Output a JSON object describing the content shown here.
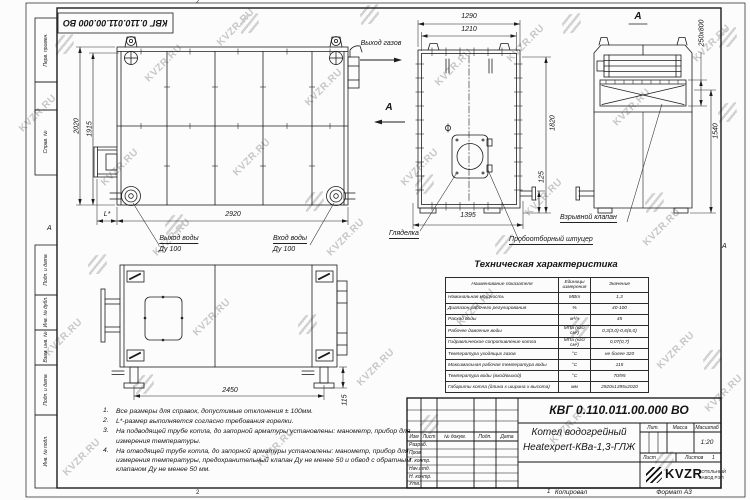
{
  "doc": {
    "number": "КВГ 0.110.011.00.000 ВО",
    "product_line1": "Котел водогрейный",
    "product_line2": "Heatexpert-КВа-1,3-ГЛЖ",
    "scale_value": "1:20",
    "sheets_value": "1",
    "copied": "Копировал",
    "format": "Формат А3",
    "company_name": "KVZR",
    "company_desc1": "КОТЕЛЬНЫЙ",
    "company_desc2": "ЗАВОД РЭП"
  },
  "stamp": {
    "header_cols": [
      "Изм",
      "Лист",
      "№ докум.",
      "Подп.",
      "Дата"
    ],
    "rows": [
      "Разраб.",
      "Пров.",
      "Т. контр.",
      "Нач.отд.",
      "Н. контр.",
      "Утв."
    ],
    "lit_label": "Лит.",
    "mass_label": "Масса",
    "scale_label": "Масштаб",
    "sheet_label": "Лист",
    "sheets_label": "Листов"
  },
  "margin_labels": {
    "perv": "Перв. примен.",
    "sprav": "Справ. №",
    "podp1": "Подп. и дата",
    "inv_dubl": "Инв. № дубл.",
    "vzam": "Взам. инв. №",
    "podp2": "Подп. и дата",
    "inv_podl": "Инв. № подл."
  },
  "zones": {
    "top": "2",
    "bottom": "2",
    "left": "А",
    "right": "А",
    "sheet_num": "1"
  },
  "views": {
    "side": {
      "dim_height_outer": "2020",
      "dim_height_inner": "1915",
      "dim_width": "2920",
      "dim_l": "L*",
      "label_gas_out": "Выход газов",
      "view_arrow": "А",
      "label_water_out1": "Выход воды",
      "label_water_out2": "Ду 100",
      "label_water_in1": "Вход воды",
      "label_water_in2": "Ду 100"
    },
    "front": {
      "dim_top1": "1290",
      "dim_top2": "1210",
      "dim_right": "1820",
      "dim_bottom_small": "125",
      "dim_bottom": "1395",
      "label_sight": "Гляделка",
      "label_sampler": "Пробоотборный штуцер"
    },
    "viewA": {
      "title": "А",
      "dim_flue": "250x800",
      "dim_height": "1540",
      "label_valve": "Взрывной клапан"
    },
    "plan": {
      "dim_width": "2450",
      "dim_feet": "115"
    }
  },
  "notes": [
    "Все размеры для справок, допустимые отклонения ± 100мм.",
    "L*-размер выполняется согласно требования горелки.",
    "На подводящей трубе котла, до запорной арматуры установлены: манометр, прибор для измерения температуры.",
    "На отводящей трубе котла, до запорной арматуры установлены: манометр, прибор для измерения температуры, предохранительный клапан Ду не менее 50 и обвод с обратным клапаном Ду не менее 50 мм."
  ],
  "table": {
    "title": "Техническая характеристика",
    "col_name": "Наименование показателя",
    "col_units": "Единицы измерения",
    "col_value": "Значение",
    "rows": [
      {
        "name": "Номинальная мощность",
        "units": "МВт",
        "value": "1,3"
      },
      {
        "name": "Диапазон рабочего регулирования",
        "units": "%",
        "value": "40-100"
      },
      {
        "name": "Расход воды",
        "units": "м³/ч",
        "value": "45"
      },
      {
        "name": "Рабочее давление воды",
        "units": "МПа (кгс/см²)",
        "value": "0,3(3,0)-0,6(6,0)"
      },
      {
        "name": "Гидравлическое сопротивление котла",
        "units": "МПа (кгс/см²)",
        "value": "0,07(0,7)"
      },
      {
        "name": "Температура уходящих газов",
        "units": "°С",
        "value": "не более 320"
      },
      {
        "name": "Максимальная рабочая температура воды",
        "units": "°С",
        "value": "115"
      },
      {
        "name": "Температура воды (вход/выход)",
        "units": "°С",
        "value": "70/95"
      },
      {
        "name": "Габариты котла (длина х ширина х высота)",
        "units": "мм",
        "value": "2920х1395х2020"
      }
    ]
  },
  "watermark": {
    "text": "KVZR.RU"
  }
}
